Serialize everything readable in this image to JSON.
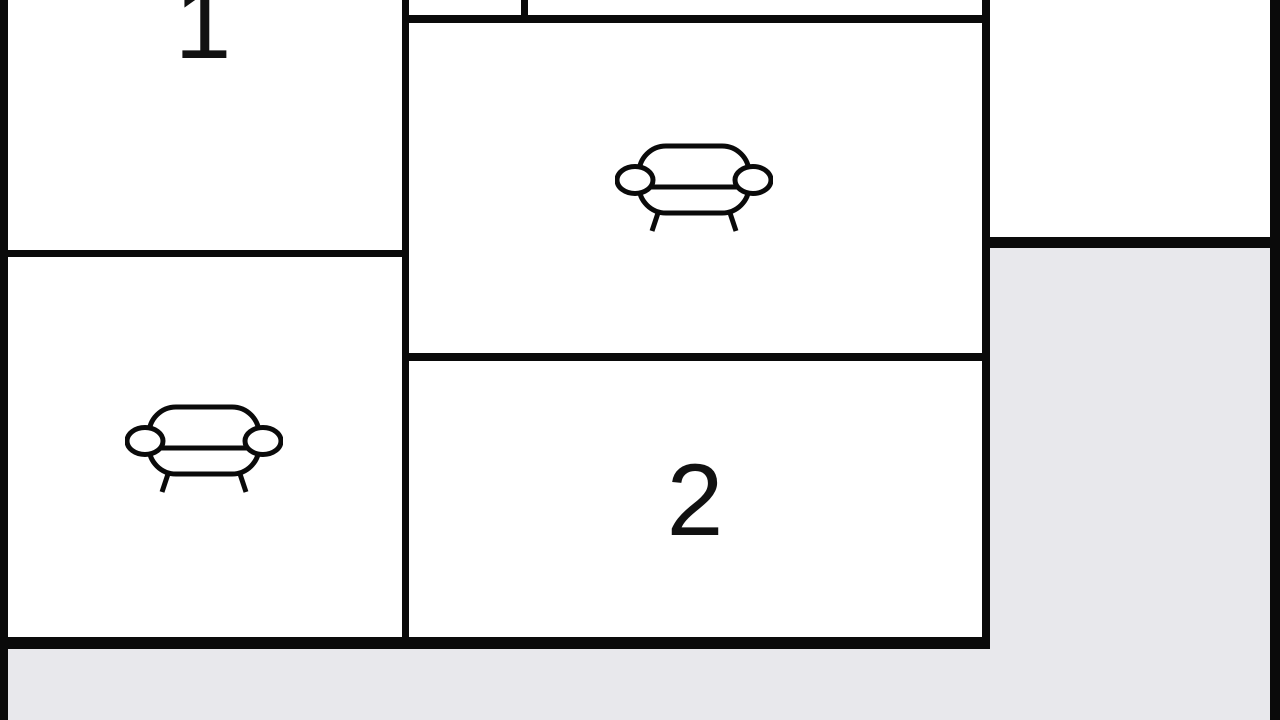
{
  "floorplan": {
    "colors": {
      "wall": "#0a0a0a",
      "room_fill": "#ffffff",
      "outside_fill": "#e8e8ec",
      "label_color": "#111111"
    },
    "rooms": {
      "room1": {
        "label": "1"
      },
      "room2": {
        "label": "2"
      },
      "living_top": {
        "furniture": "sofa"
      },
      "living_left": {
        "furniture": "sofa"
      },
      "top_right": {
        "label": ""
      }
    }
  }
}
